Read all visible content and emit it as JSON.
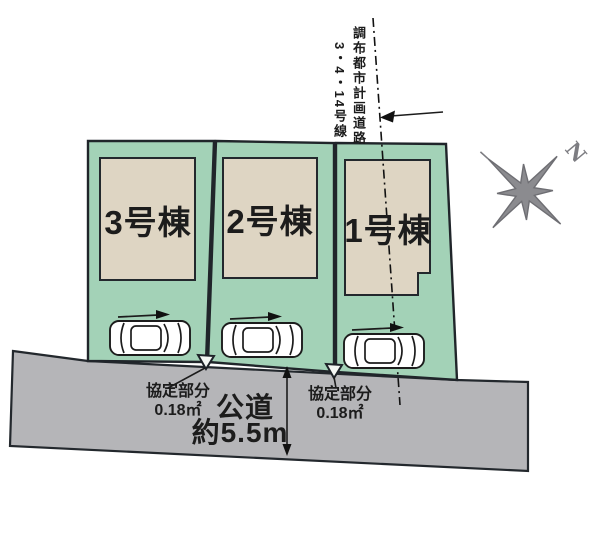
{
  "site_plan": {
    "planned_road": {
      "name": "調布都市計画道路",
      "line": "3・4・14号線"
    },
    "lots": [
      {
        "label": "3号棟"
      },
      {
        "label": "2号棟"
      },
      {
        "label": "1号棟"
      }
    ],
    "agreements": {
      "left": {
        "title": "協定部分",
        "area": "0.18㎡"
      },
      "right": {
        "title": "協定部分",
        "area": "0.18㎡"
      }
    },
    "road": {
      "type": "公道",
      "width": "約5.5m"
    },
    "compass": {
      "north": "N"
    },
    "colors": {
      "lot_green": "#a3d2b7",
      "building_beige": "#ded5c3",
      "road_gray": "#b5b5b8",
      "outline": "#1c1c1c",
      "compass_gray": "#8b8b8f"
    }
  }
}
